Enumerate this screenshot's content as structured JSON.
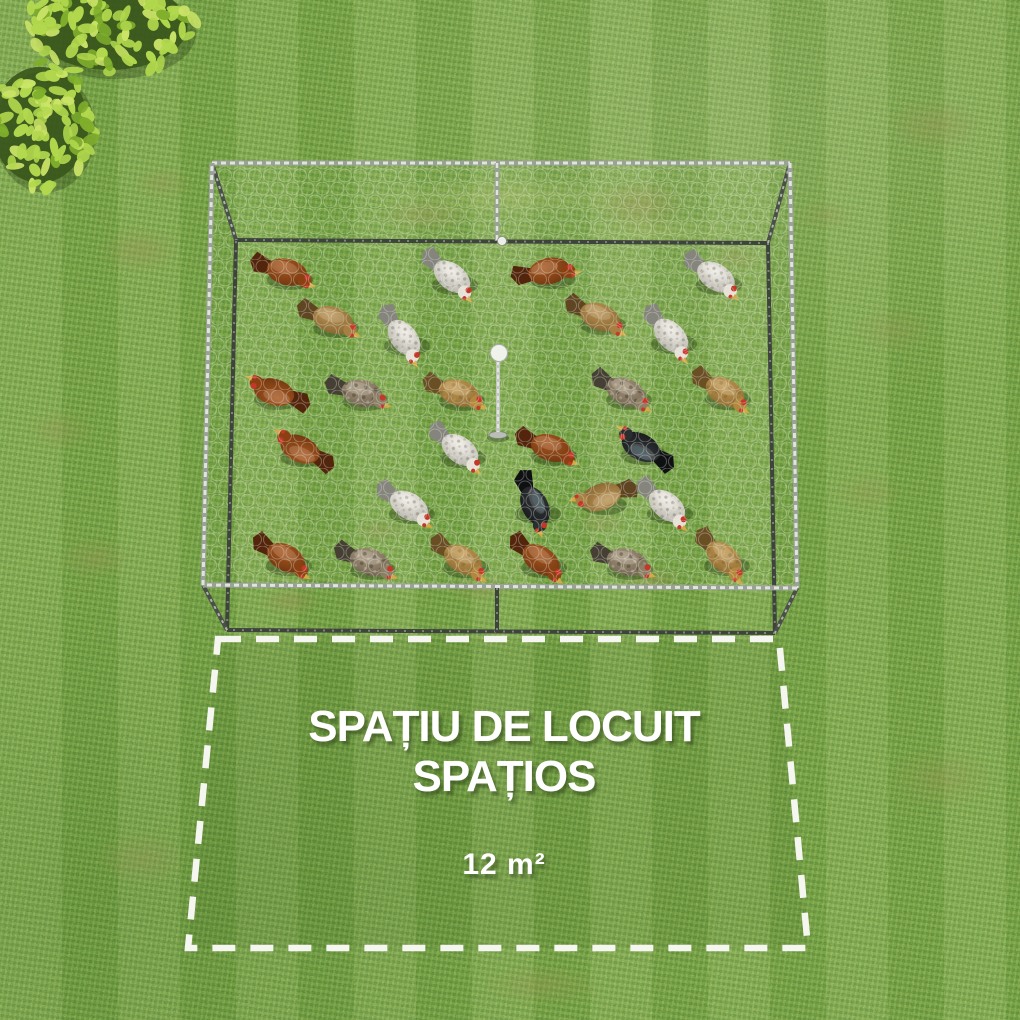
{
  "overlay_text": {
    "headline_line1": "SPAȚIU DE LOCUIT",
    "headline_line2": "SPAȚIOS",
    "area_value": "12 m²"
  },
  "palette": {
    "grass_base": "#78a44a",
    "grass_light": "#9cc468",
    "grass_dark": "#5d8a38",
    "dirt_patch": "#9a9454",
    "bush_leaf_light": "#cbe468",
    "bush_leaf_mid": "#b2d84e",
    "bush_leaf_dark": "#7fae2c",
    "bush_shadow": "#3a571c",
    "frame_light": "#e8ece4",
    "frame_mid": "#9aa199",
    "frame_dark": "#3e433d",
    "mesh_white": "#f0f4ea",
    "dashed_line": "#f6f6f0",
    "text_white": "#ffffff",
    "comb_red": "#c5372a",
    "beak_yellow": "#d9a843"
  },
  "cage": {
    "roof_corners": [
      [
        212,
        163
      ],
      [
        790,
        163
      ],
      [
        797,
        588
      ],
      [
        203,
        585
      ]
    ],
    "base_corners": [
      [
        236,
        240
      ],
      [
        768,
        243
      ],
      [
        775,
        633
      ],
      [
        227,
        630
      ]
    ],
    "center_rail_top": [
      [
        497,
        163
      ],
      [
        497,
        241
      ]
    ],
    "center_rail_bottom": [
      [
        497,
        588
      ],
      [
        497,
        632
      ]
    ],
    "knob": {
      "x": 502,
      "y": 241
    },
    "pole": {
      "x": 498,
      "ball_y": 353,
      "top_y": 361,
      "base_y": 432,
      "plate_y": 435
    }
  },
  "dashed_area": {
    "corners": [
      [
        218,
        639
      ],
      [
        779,
        639
      ],
      [
        808,
        948
      ],
      [
        188,
        948
      ]
    ]
  },
  "chickens": [
    {
      "x": 287,
      "y": 272,
      "type": "rust",
      "angle": 14
    },
    {
      "x": 452,
      "y": 277,
      "type": "white",
      "angle": 38
    },
    {
      "x": 549,
      "y": 271,
      "type": "rust",
      "angle": -12
    },
    {
      "x": 716,
      "y": 277,
      "type": "white",
      "angle": 32
    },
    {
      "x": 333,
      "y": 320,
      "type": "tan",
      "angle": 18
    },
    {
      "x": 404,
      "y": 338,
      "type": "white",
      "angle": 52
    },
    {
      "x": 600,
      "y": 317,
      "type": "tan",
      "angle": 22
    },
    {
      "x": 671,
      "y": 336,
      "type": "white",
      "angle": 46
    },
    {
      "x": 274,
      "y": 392,
      "type": "rust",
      "angle": 196
    },
    {
      "x": 362,
      "y": 393,
      "type": "speckled",
      "angle": 12
    },
    {
      "x": 459,
      "y": 393,
      "type": "gold",
      "angle": 16
    },
    {
      "x": 626,
      "y": 392,
      "type": "speckled",
      "angle": 24
    },
    {
      "x": 725,
      "y": 392,
      "type": "gold",
      "angle": 28
    },
    {
      "x": 300,
      "y": 449,
      "type": "rust",
      "angle": 204
    },
    {
      "x": 460,
      "y": 450,
      "type": "white",
      "angle": 36
    },
    {
      "x": 551,
      "y": 448,
      "type": "rust",
      "angle": 18
    },
    {
      "x": 641,
      "y": 447,
      "type": "black",
      "angle": 208
    },
    {
      "x": 409,
      "y": 506,
      "type": "white",
      "angle": 30
    },
    {
      "x": 535,
      "y": 506,
      "type": "black",
      "angle": 64
    },
    {
      "x": 601,
      "y": 497,
      "type": "tan",
      "angle": 160
    },
    {
      "x": 667,
      "y": 506,
      "type": "white",
      "angle": 38
    },
    {
      "x": 286,
      "y": 558,
      "type": "rust",
      "angle": 28
    },
    {
      "x": 370,
      "y": 562,
      "type": "speckled",
      "angle": 18
    },
    {
      "x": 463,
      "y": 560,
      "type": "gold",
      "angle": 30
    },
    {
      "x": 541,
      "y": 560,
      "type": "rust",
      "angle": 34
    },
    {
      "x": 627,
      "y": 562,
      "type": "speckled",
      "angle": 14
    },
    {
      "x": 724,
      "y": 558,
      "type": "gold",
      "angle": 42
    }
  ],
  "chicken_colors": {
    "rust": {
      "body": "#a8581f",
      "body2": "#6e3410",
      "tail": "#53250c",
      "head": "#8c4012"
    },
    "white": {
      "body": "#efece4",
      "body2": "#b5b2a8",
      "tail": "#85857e",
      "head": "#e6e2d8"
    },
    "tan": {
      "body": "#bb9555",
      "body2": "#84612f",
      "tail": "#5f4522",
      "head": "#a87f42"
    },
    "gold": {
      "body": "#c49a52",
      "body2": "#8a6830",
      "tail": "#6a4e24",
      "head": "#b3873d"
    },
    "speckled": {
      "body": "#a39379",
      "body2": "#6f6350",
      "tail": "#464034",
      "head": "#8d7f66"
    },
    "black": {
      "body": "#34383a",
      "body2": "#17191b",
      "tail": "#0e1012",
      "head": "#2a2e30"
    }
  }
}
